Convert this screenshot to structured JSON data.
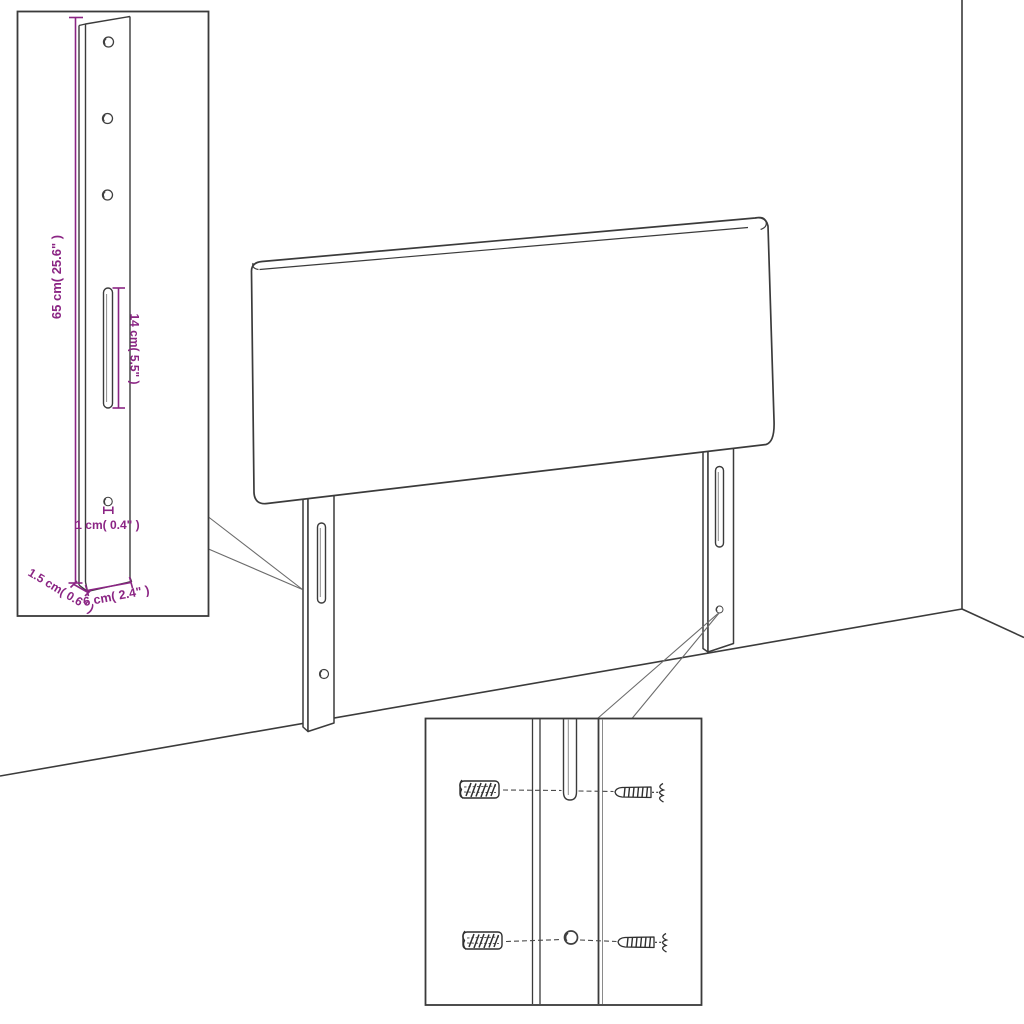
{
  "diagram": {
    "type": "product-assembly-diagram",
    "subject": "upholstered headboard with two mounting legs, wall corner scene, detail insets",
    "colors": {
      "line": "#3b3b3b",
      "dimension": "#8b2584",
      "leader": "#6b6b6b",
      "background": "#ffffff"
    },
    "dimensions": {
      "leg_height": "65 cm( 25.6\" )",
      "slot_length": "14 cm( 5.5\" )",
      "hole_diameter": "1 cm( 0.4\" )",
      "leg_thickness": "1.5 cm( 0.6\" )",
      "leg_width": "6 cm( 2.4\" )"
    }
  }
}
